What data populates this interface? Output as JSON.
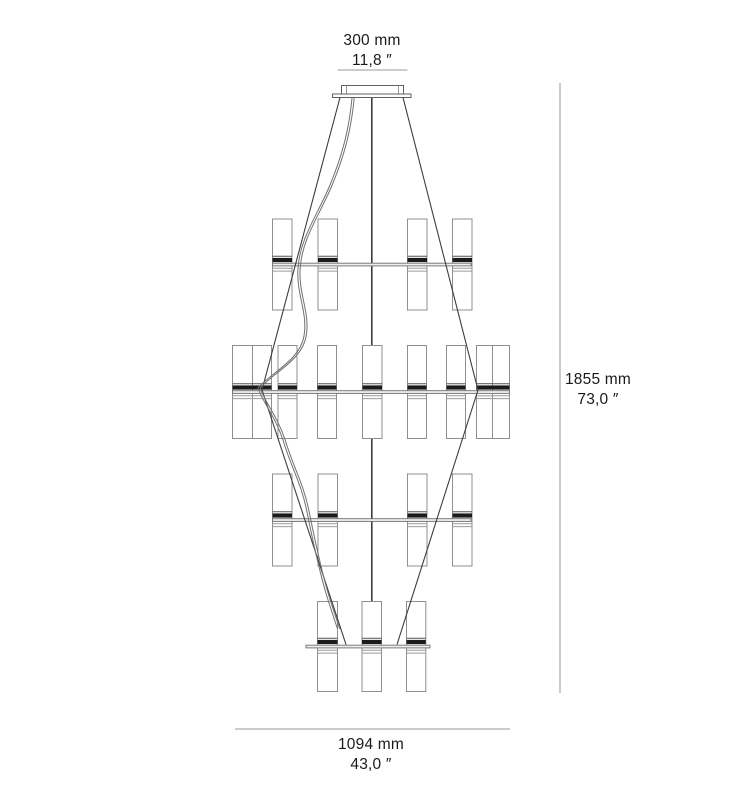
{
  "dimensions": {
    "canopy_width": {
      "mm": "300 mm",
      "inch": "11,8 ″"
    },
    "overall_height": {
      "mm": "1855 mm",
      "inch": "73,0 ″"
    },
    "overall_width": {
      "mm": "1094 mm",
      "inch": "43,0 ″"
    }
  },
  "colors": {
    "background": "#ffffff",
    "text": "#1a1a1a",
    "dimension_line": "#aeaeae",
    "outline": "#8f8f8f",
    "detail_line": "#999999",
    "socket_dark": "#1b1b1b",
    "arm_fill": "#efefef",
    "arm_stroke": "#6e6e6e",
    "cable": "#3d3d3d",
    "cord": "#707070",
    "canopy_stroke": "#5f5f5f"
  },
  "drawing": {
    "canvas": {
      "w": 753,
      "h": 793
    },
    "canopy": {
      "box": {
        "x": 341.5,
        "y": 85.5,
        "w": 62,
        "h": 8.5
      },
      "flange": {
        "x": 332.5,
        "y": 94,
        "w": 78.5,
        "h": 3.5
      },
      "inner_lines_x": [
        346.5,
        398.5
      ]
    },
    "rod": {
      "x": 371.8,
      "y1": 97.5,
      "y2": 601.5
    },
    "tiers": [
      {
        "arm_y": 264.5,
        "arm_x1": 272.5,
        "arm_x2": 471,
        "top": 219,
        "h": 91,
        "candles": [
          {
            "x": 272.5,
            "w": 19.5
          },
          {
            "x": 318,
            "w": 19.5
          },
          {
            "x": 407.5,
            "w": 19.5
          },
          {
            "x": 452.5,
            "w": 19.5
          }
        ]
      },
      {
        "arm_y": 392,
        "arm_x1": 232.5,
        "arm_x2": 509.5,
        "top": 345.5,
        "h": 93,
        "candles": [
          {
            "x": 232.5,
            "w": 20
          },
          {
            "x": 252.5,
            "w": 19
          },
          {
            "x": 278,
            "w": 19
          },
          {
            "x": 317.5,
            "w": 19
          },
          {
            "x": 362.5,
            "w": 19.5
          },
          {
            "x": 407.5,
            "w": 19
          },
          {
            "x": 446.5,
            "w": 19
          },
          {
            "x": 476.5,
            "w": 16
          },
          {
            "x": 492.5,
            "w": 17
          }
        ]
      },
      {
        "arm_y": 520,
        "arm_x1": 272.5,
        "arm_x2": 471,
        "top": 474,
        "h": 92,
        "candles": [
          {
            "x": 272.5,
            "w": 19.5
          },
          {
            "x": 318,
            "w": 19.5
          },
          {
            "x": 407.5,
            "w": 19.5
          },
          {
            "x": 452.5,
            "w": 19.5
          }
        ]
      },
      {
        "arm_y": 646.5,
        "arm_x1": 306,
        "arm_x2": 430,
        "top": 601.5,
        "h": 90,
        "candles": [
          {
            "x": 317.5,
            "w": 20
          },
          {
            "x": 362,
            "w": 19.5
          },
          {
            "x": 406.5,
            "w": 19.3
          }
        ]
      }
    ],
    "cables": [
      [
        340,
        97.5,
        262,
        390
      ],
      [
        262,
        390,
        346,
        644.5
      ],
      [
        403,
        97.5,
        478,
        390
      ],
      [
        478,
        390,
        397,
        644.5
      ]
    ],
    "cord": {
      "d": "M352,98 C349,130 342,156 330,185 C318,214 300,238 298,268 C296,294 308,312 304,336 C300,360 272,372 258,388 C262,401 275,416 283,440 C292,470 301,482 307,512 C313,542 318,565 325,590 C330,607 334,618 337.5,629",
      "offset_x": 2.2
    },
    "dimension_lines": {
      "top": {
        "x1": 337.5,
        "y1": 70,
        "x2": 407.5,
        "y2": 70
      },
      "right": {
        "x1": 560,
        "y1": 83,
        "x2": 560,
        "y2": 693
      },
      "bottom": {
        "x1": 235,
        "y1": 729,
        "x2": 510,
        "y2": 729
      }
    }
  }
}
